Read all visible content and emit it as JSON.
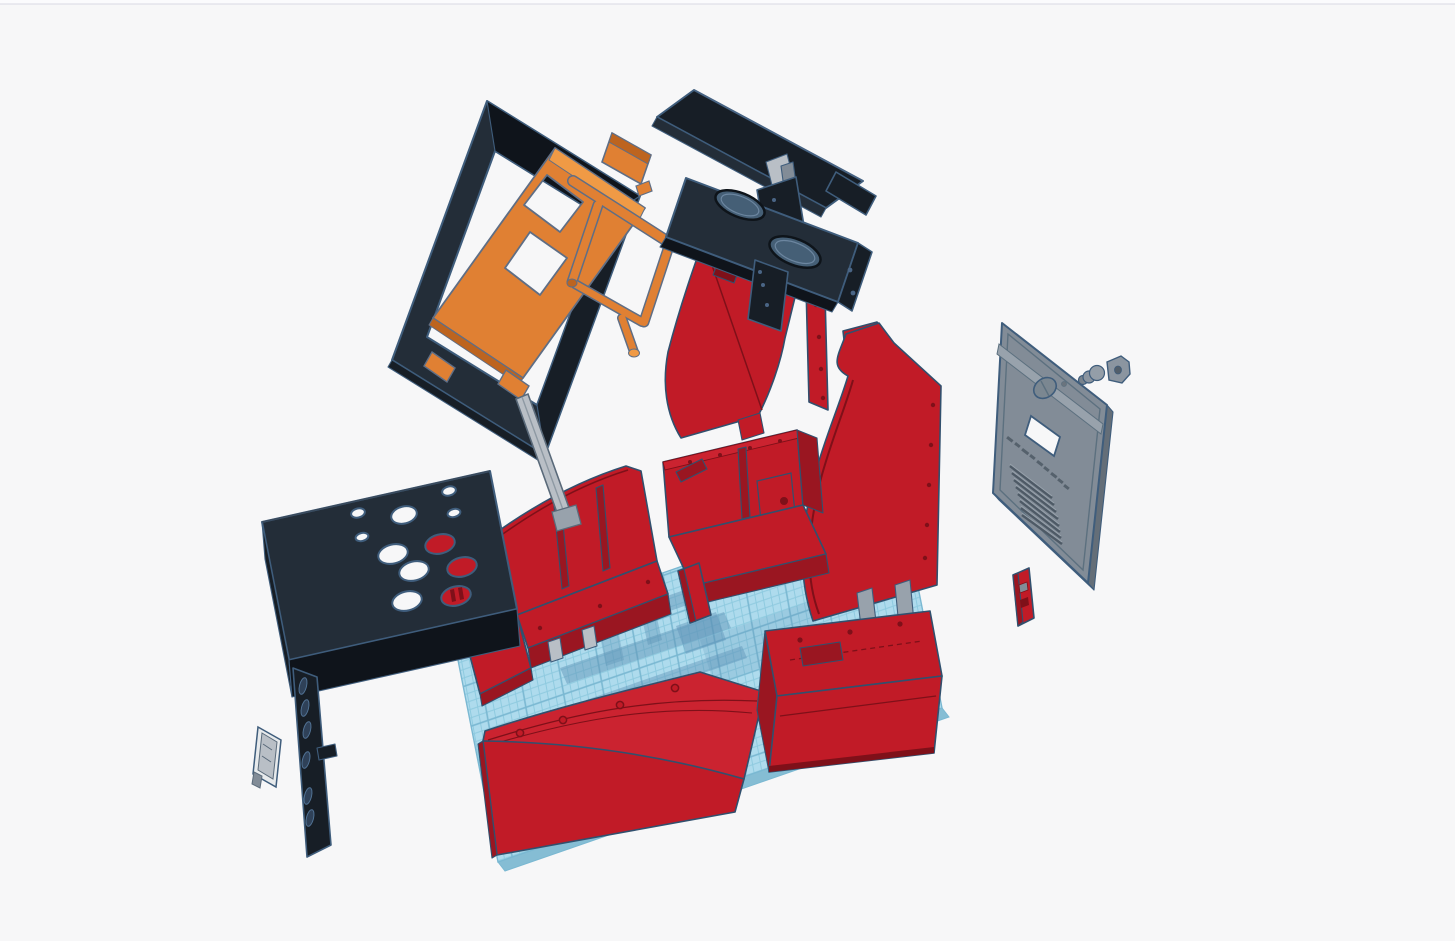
{
  "viewport": {
    "kind": "3d-cad-exploded-assembly-view",
    "width": 1455,
    "height": 941
  },
  "palette": {
    "bg": "#f7f7f8",
    "topbar": "#fbfbfd",
    "topbarBorder": "#d9dae3",
    "outline": "#3f5d7c",
    "redOutline": "#31506e",
    "red": "#c11b27",
    "redLight": "#cb2330",
    "redDark": "#9a1621",
    "redDeep": "#7f1019",
    "black": "#232d38",
    "blackLight": "#33404d",
    "blackDark": "#171e26",
    "blackDeep": "#0f141b",
    "orange": "#e08033",
    "orangeLight": "#f09a45",
    "orangeDark": "#bd641f",
    "gray": "#828c97",
    "grayLight": "#98a2ac",
    "grayDark": "#646e78",
    "lightBar": "#b9bfc6",
    "plateWhite": "#e7eaec",
    "gridBase": "#aedbed",
    "gridMinor": "#8ecadf",
    "gridMajor": "#7ab8d2",
    "gridEdge": "#85bdd4",
    "shadow": "#5b90b4",
    "holeBlue": "#455f76",
    "holeRim": "#0e141a",
    "slotBlue": "#2f4158",
    "slotRim": "#507193"
  },
  "workplane": {
    "name": "workplane-grid",
    "minor_cell_px": 8,
    "major_cell_px": 40
  },
  "parts": [
    {
      "id": "screen-bezel-frame",
      "color": "black"
    },
    {
      "id": "monitor-mount-frame",
      "color": "orange"
    },
    {
      "id": "monitor-stand-tubes",
      "color": "orange"
    },
    {
      "id": "small-orange-bracket",
      "color": "orange"
    },
    {
      "id": "marquee-panel",
      "color": "black"
    },
    {
      "id": "marquee-hinge",
      "color": "gray"
    },
    {
      "id": "marquee-bracket",
      "color": "black"
    },
    {
      "id": "speaker-deck",
      "color": "black"
    },
    {
      "id": "speaker-bracket",
      "color": "black"
    },
    {
      "id": "upper-side-panel",
      "color": "red"
    },
    {
      "id": "side-panel-right-curved",
      "color": "red"
    },
    {
      "id": "side-panel-top-bracket",
      "color": "red"
    },
    {
      "id": "back-door-panel",
      "color": "gray"
    },
    {
      "id": "power-plug",
      "color": "gray"
    },
    {
      "id": "lock-plate",
      "color": "gray"
    },
    {
      "id": "door-latch",
      "color": "red"
    },
    {
      "id": "base-box-left",
      "color": "red"
    },
    {
      "id": "base-box-center",
      "color": "red"
    },
    {
      "id": "support-post",
      "color": "red"
    },
    {
      "id": "front-panel-left",
      "color": "red"
    },
    {
      "id": "front-box-right",
      "color": "red"
    },
    {
      "id": "control-panel",
      "color": "black"
    },
    {
      "id": "side-vent-strip",
      "color": "black"
    },
    {
      "id": "small-side-plate",
      "color": "white"
    },
    {
      "id": "guide-rail",
      "color": "lightgray"
    },
    {
      "id": "workplane-grid",
      "color": "blue"
    }
  ]
}
